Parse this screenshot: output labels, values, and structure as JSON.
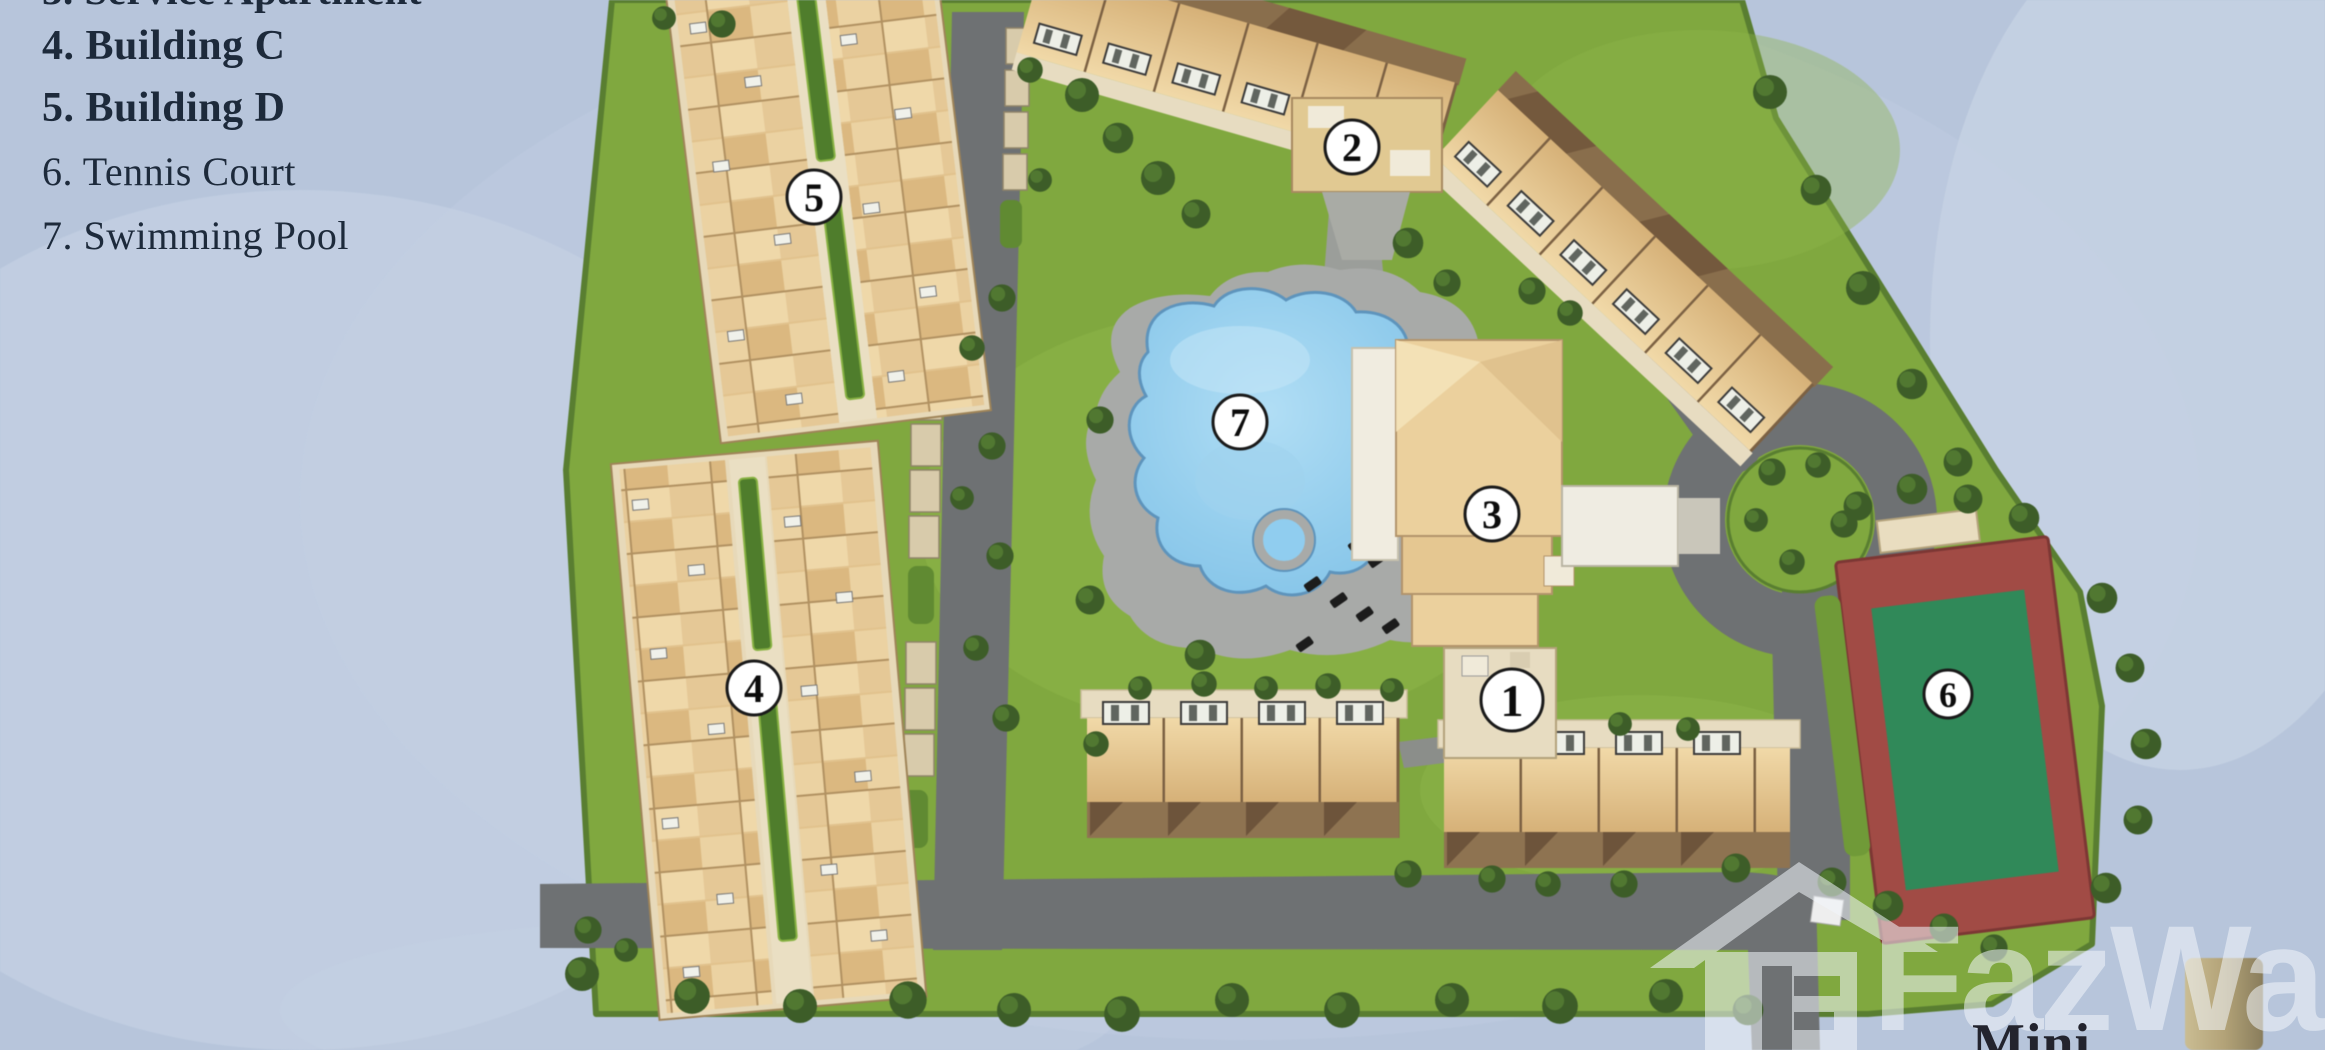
{
  "legend": {
    "clipped_top_line": "3. Service Apartment",
    "items": [
      {
        "text": "4. Building C"
      },
      {
        "text": "5. Building D"
      },
      {
        "text": "6. Tennis Court"
      },
      {
        "text": "7. Swimming Pool"
      }
    ]
  },
  "map": {
    "markers": [
      {
        "label": "1"
      },
      {
        "label": "2"
      },
      {
        "label": "3"
      },
      {
        "label": "4"
      },
      {
        "label": "5"
      },
      {
        "label": "6"
      },
      {
        "label": "7"
      }
    ]
  },
  "watermark": {
    "brand": "FazWaz"
  },
  "labels": {
    "bottom_right_partial": "Mini"
  },
  "colors": {
    "background_water": "#b7c5db",
    "grass": "#7fa83c",
    "asphalt": "#6e7173",
    "pool_blue": "#8ecdf0",
    "tennis_red": "#a34a44",
    "tennis_green": "#2e8a58",
    "roof_beige": "#ecd09b",
    "roof_brown": "#8f7350"
  }
}
